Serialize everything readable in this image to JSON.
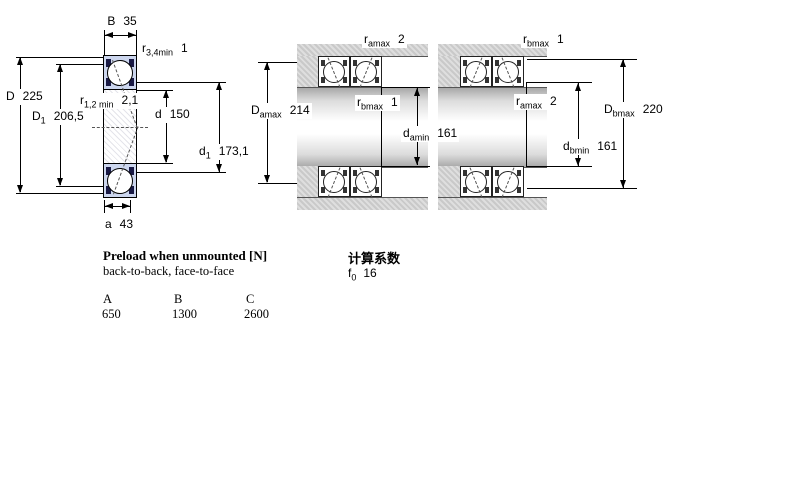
{
  "diagram_labels": {
    "left": {
      "B": {
        "base": "B",
        "sub": "",
        "value": "35"
      },
      "r34": {
        "base": "r",
        "sub": "3,4min",
        "value": "1"
      },
      "D": {
        "base": "D",
        "sub": "",
        "value": "225"
      },
      "D1": {
        "base": "D",
        "sub": "1",
        "value": "206,5"
      },
      "r12": {
        "base": "r",
        "sub": "1,2 min",
        "value": "2,1"
      },
      "d": {
        "base": "d",
        "sub": "",
        "value": "150"
      },
      "d1": {
        "base": "d",
        "sub": "1",
        "value": "173,1"
      },
      "a": {
        "base": "a",
        "sub": "",
        "value": "43"
      }
    },
    "middle": {
      "ramax": {
        "base": "r",
        "sub": "amax",
        "value": "2"
      },
      "rbmax": {
        "base": "r",
        "sub": "bmax",
        "value": "1"
      },
      "Damax": {
        "base": "D",
        "sub": "amax",
        "value": "214"
      },
      "damin": {
        "base": "d",
        "sub": "amin",
        "value": "161"
      }
    },
    "right": {
      "rbmax": {
        "base": "r",
        "sub": "bmax",
        "value": "1"
      },
      "ramax": {
        "base": "r",
        "sub": "amax",
        "value": "2"
      },
      "Dbmax": {
        "base": "D",
        "sub": "bmax",
        "value": "220"
      },
      "dbmin": {
        "base": "d",
        "sub": "bmin",
        "value": "161"
      }
    }
  },
  "preload": {
    "title": "Preload when unmounted [N]",
    "subtitle": "back-to-back, face-to-face",
    "table": {
      "headers": [
        "A",
        "B",
        "C"
      ],
      "values": [
        "650",
        "1300",
        "2600"
      ]
    }
  },
  "calculation": {
    "title": "计算系数",
    "factor": {
      "base": "f",
      "sub": "0",
      "value": "16"
    }
  },
  "colors": {
    "bearing_fill": "#ccd6ee",
    "bearing_race": "#191945",
    "housing_gray": "#c9c9c9",
    "line": "#000000"
  }
}
